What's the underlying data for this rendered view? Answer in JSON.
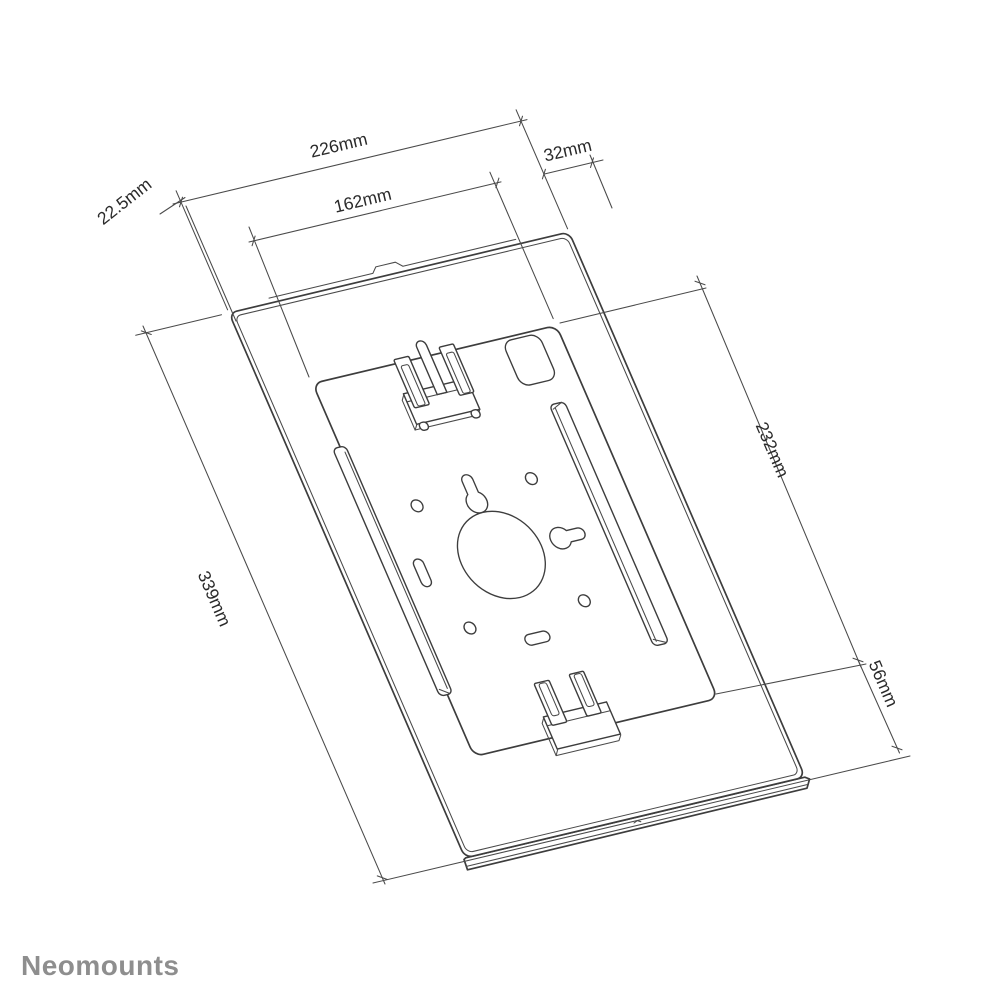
{
  "drawing": {
    "type": "technical-dimension-drawing",
    "dimension_labels": {
      "front_width": "226mm",
      "top_right_offset": "32mm",
      "edge_depth": "22.5mm",
      "opening_width": "162mm",
      "opening_height": "232mm",
      "bottom_section_height": "56mm",
      "front_height": "339mm"
    }
  },
  "brand": {
    "logo_text": "Neomounts"
  },
  "colors": {
    "background": "#ffffff",
    "line_color": "#3d3d3d",
    "dimension_line_color": "#4a4a4a",
    "dimension_text_color": "#2a2a2a",
    "logo_color": "#8e8e8e"
  }
}
